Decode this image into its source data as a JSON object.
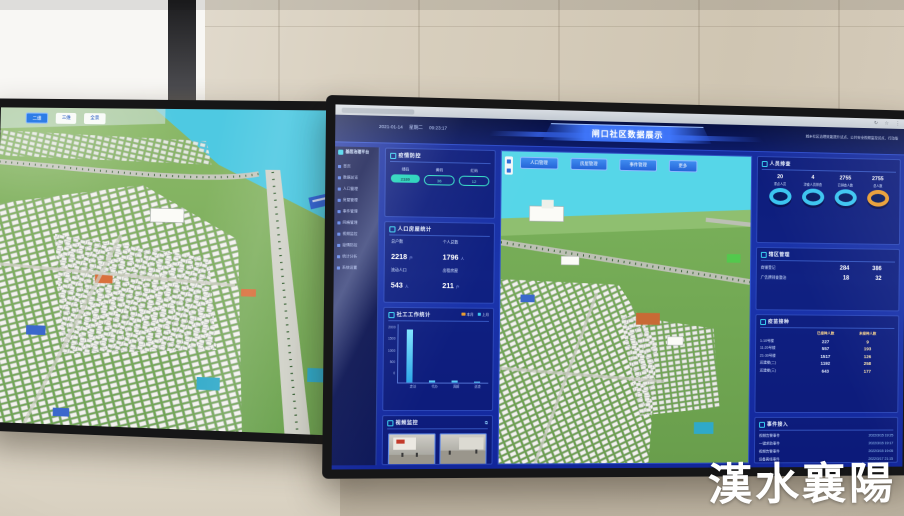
{
  "scene": {
    "watermark_text": "漢水襄陽"
  },
  "theme": {
    "dashboard_blue": "#1b35ad",
    "panel_blue": "#10207f",
    "accent_teal": "#1ed2b8",
    "accent_cyan": "#3ac4f0",
    "accent_orange": "#e89c32",
    "button_blue": "#2e7de6"
  },
  "left_monitor": {
    "map_chips": [
      "二维",
      "三维",
      "全景"
    ]
  },
  "right_monitor": {
    "browser": {
      "icons": [
        "↻",
        "☆",
        "⋮"
      ]
    },
    "sidebar": {
      "logo_text": "基层治理平台",
      "items": [
        "首页",
        "数据总览",
        "人口管理",
        "房屋管理",
        "事件管理",
        "网格管理",
        "视频监控",
        "疫情防控",
        "统计分析",
        "系统设置"
      ]
    },
    "header": {
      "date": "2021-01-14",
      "weekday": "星期二",
      "time": "09:23:17",
      "title": "闸口社区数据展示",
      "slogan": "城乡社区治理效能提升试点、公共安全视频监控试点、行动版"
    },
    "map_buttons": [
      "人口管理",
      "房屋管理",
      "事件管理",
      "更多"
    ],
    "panels": {
      "health": {
        "title": "疫情防控",
        "items": [
          {
            "label": "绿码",
            "value": "2180"
          },
          {
            "label": "黄码",
            "value": "36"
          },
          {
            "label": "红码",
            "value": "12"
          }
        ]
      },
      "population": {
        "title": "人口房屋统计",
        "stats": [
          {
            "label": "总户数",
            "value": "2218",
            "unit": "户"
          },
          {
            "label": "个人总数",
            "value": "1796",
            "unit": "人"
          },
          {
            "label": "流动人口",
            "value": "543",
            "unit": "人"
          },
          {
            "label": "出租房屋",
            "value": "211",
            "unit": "户"
          }
        ]
      },
      "work": {
        "title": "社工工作统计",
        "legend": [
          {
            "label": "本月",
            "color": "#e89c32"
          },
          {
            "label": "上月",
            "color": "#3ac4f0"
          }
        ]
      },
      "video": {
        "title": "视频监控",
        "expand_icon": "⧉"
      },
      "screening": {
        "title": "人员排查",
        "gauges": [
          {
            "value": "20",
            "label": "重点人员",
            "color": "#3ac4f0"
          },
          {
            "value": "4",
            "label": "涉疫人员排查",
            "color": "#3ac4f0"
          },
          {
            "value": "2755",
            "label": "已排查人数",
            "color": "#3ac4f0"
          },
          {
            "value": "2755",
            "label": "总人数",
            "color": "#e89c32"
          }
        ]
      },
      "premises": {
        "title": "辖区管理",
        "rows": [
          {
            "label": "商铺登记",
            "v1": "284",
            "v2": "386"
          },
          {
            "label": "广告牌排查整治",
            "v1": "18",
            "v2": "32"
          }
        ]
      },
      "vaccine": {
        "title": "疫苗接种",
        "col1": "已接种人数",
        "col2": "未接种人数",
        "rows": [
          {
            "label": "1-10号楼",
            "v1": "227",
            "v2": "9"
          },
          {
            "label": "11-20号楼",
            "v1": "557",
            "v2": "193"
          },
          {
            "label": "21-30号楼",
            "v1": "1517",
            "v2": "126"
          },
          {
            "label": "还建楼(二)",
            "v1": "1192",
            "v2": "258"
          },
          {
            "label": "还建楼(三)",
            "v1": "643",
            "v2": "177"
          }
        ]
      },
      "events": {
        "title": "事件接入",
        "rows": [
          {
            "label": "视频告警事件",
            "time": "2022/3/15 19:25"
          },
          {
            "label": "一键求助事件",
            "time": "2022/3/15 19:17"
          },
          {
            "label": "视频告警事件",
            "time": "2022/3/15 19:05"
          },
          {
            "label": "设备离线事件",
            "time": "2022/3/17 21:15"
          },
          {
            "label": "视频告警事件",
            "time": "2022/3/17 21:05"
          }
        ]
      }
    }
  },
  "chart_data": {
    "type": "bar",
    "title": "社工工作统计",
    "categories": [
      "走访",
      "代办",
      "调解",
      "巡查"
    ],
    "series": [
      {
        "name": "本月",
        "values": [
          1850,
          80,
          60,
          45
        ]
      }
    ],
    "ylabel": "",
    "xlabel": "",
    "ylim": [
      0,
      2000
    ],
    "yticks": [
      0,
      500,
      1000,
      1500,
      2000
    ],
    "bar_heights_pct": [
      92,
      4,
      3,
      2.5
    ],
    "legend_position": "top-right",
    "grid": false
  }
}
